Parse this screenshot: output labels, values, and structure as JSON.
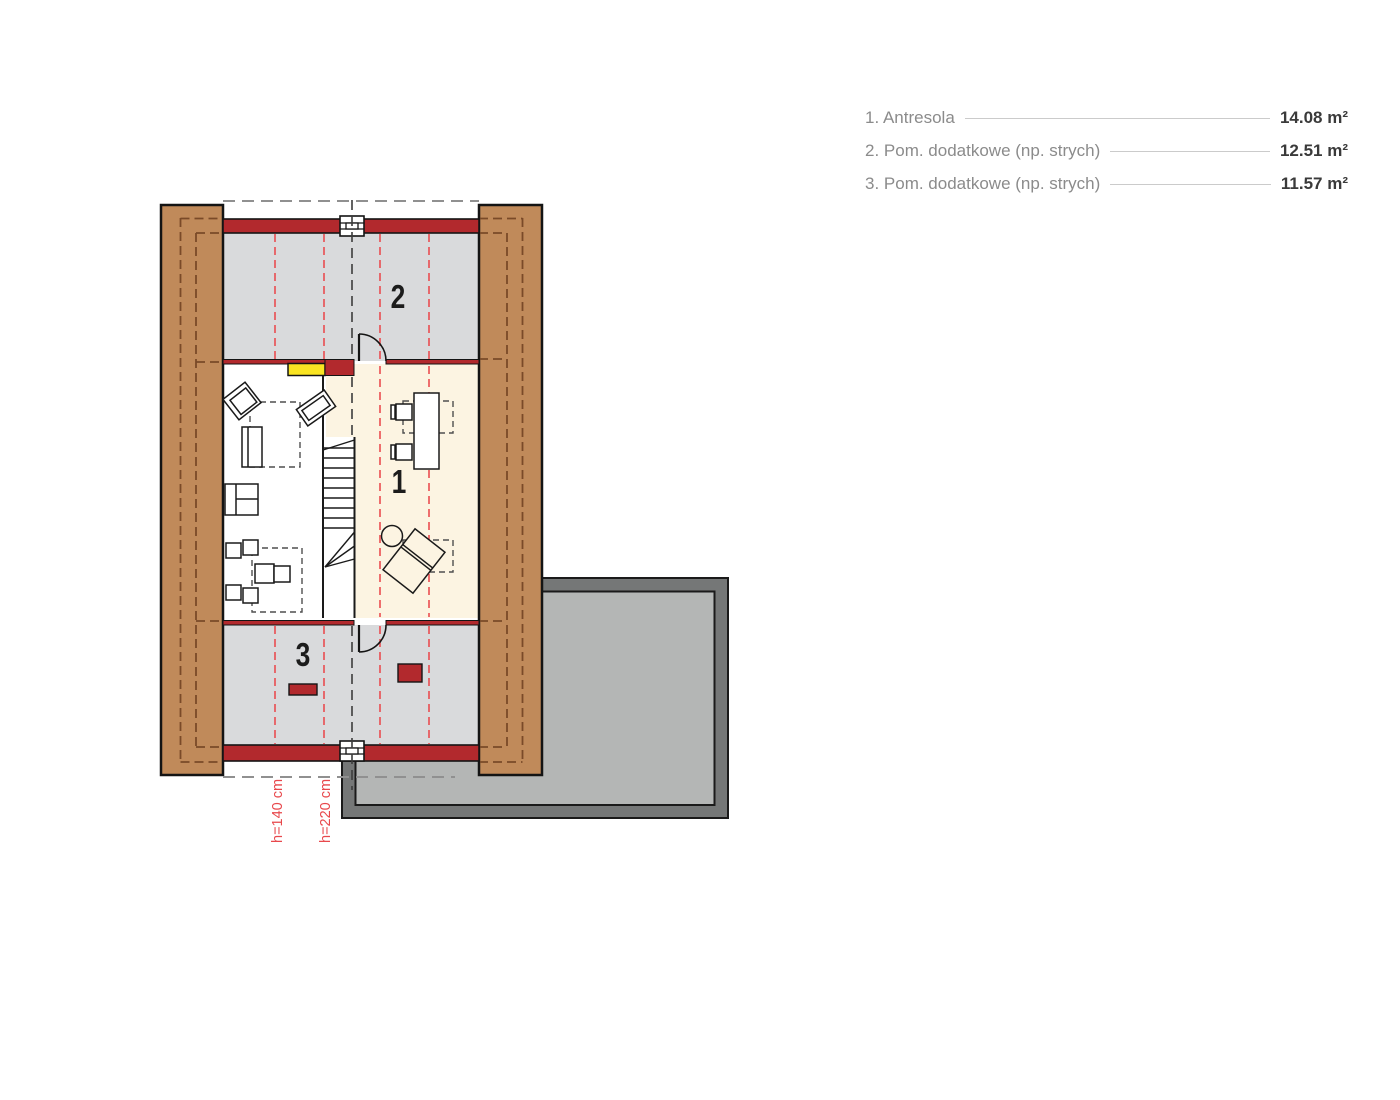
{
  "legend": {
    "items": [
      {
        "label": "1. Antresola",
        "value": "14.08 m²"
      },
      {
        "label": "2. Pom. dodatkowe (np. strych)",
        "value": "12.51 m²"
      },
      {
        "label": "3. Pom. dodatkowe (np. strych)",
        "value": "11.57 m²"
      }
    ]
  },
  "plan": {
    "room_numbers": {
      "antresola": "1",
      "strych_top": "2",
      "strych_bottom": "3"
    },
    "height_lines": [
      {
        "label": "h=140 cm"
      },
      {
        "label": "h=220 cm"
      }
    ],
    "colors": {
      "wall_wood": "#c08a5a",
      "wood_dash": "#7a4a28",
      "wall_red": "#b2292d",
      "accent_yellow": "#f9e422",
      "room_gray": "#d9dadc",
      "room_cream": "#fcf4e2",
      "terrace_dark": "#757777",
      "terrace_light": "#b4b6b5",
      "height_line_red": "#e8484c"
    }
  }
}
